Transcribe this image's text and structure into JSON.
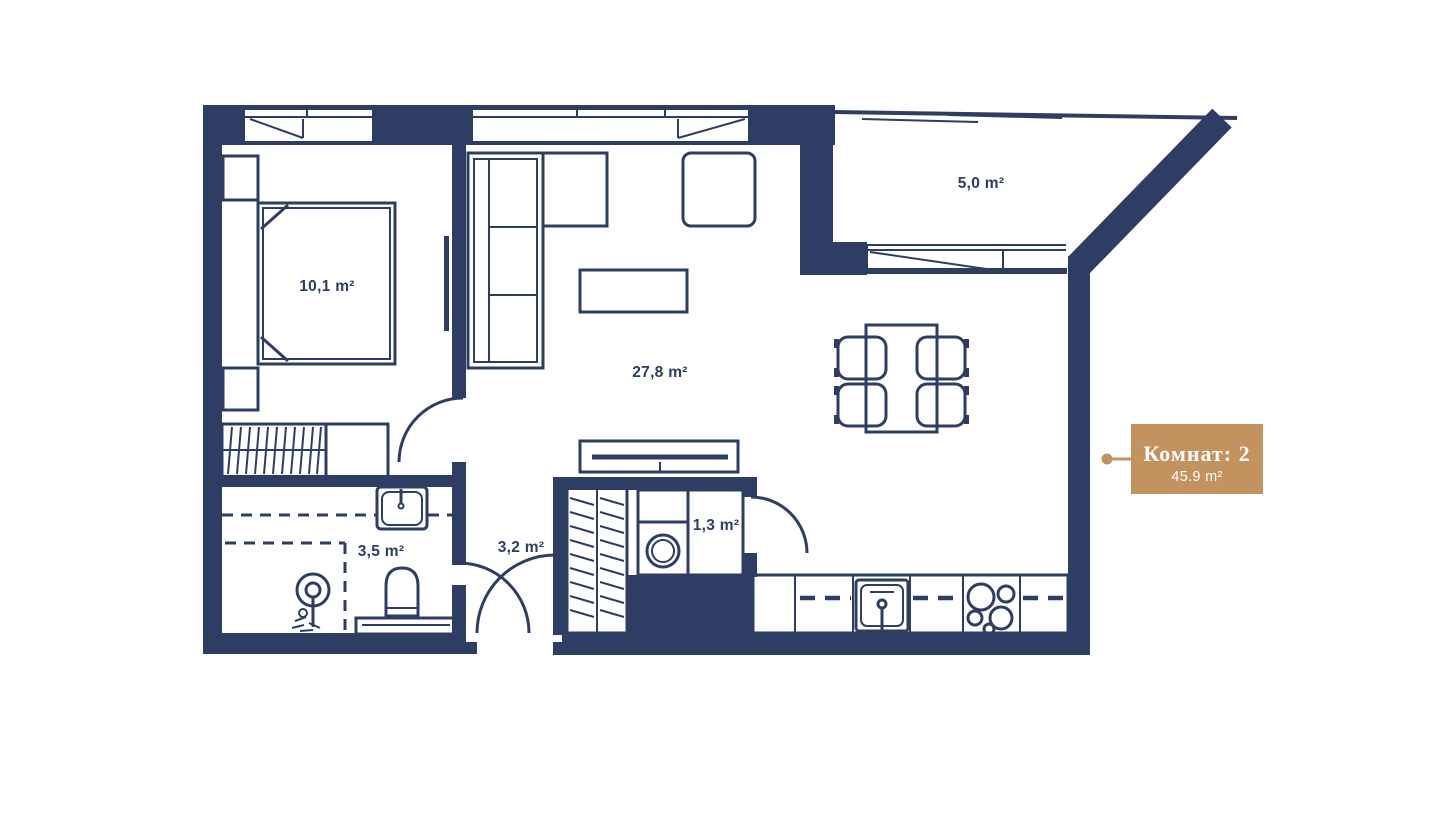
{
  "plan": {
    "badge": {
      "title": "Комнат: 2",
      "area": "45.9 m²"
    },
    "rooms": {
      "bedroom": {
        "name": "bedroom",
        "area": "10,1 m²"
      },
      "living": {
        "name": "living-room",
        "area": "27,8 m²"
      },
      "balcony": {
        "name": "balcony",
        "area": "5,0 m²"
      },
      "bathroom": {
        "name": "bathroom",
        "area": "3,5 m²"
      },
      "hallway": {
        "name": "hallway",
        "area": "3,2 m²"
      },
      "utility": {
        "name": "utility-closet",
        "area": "1,3 m²"
      }
    },
    "colors": {
      "wall": "#2d3d63",
      "accent": "#c2935e",
      "background": "#ffffff"
    }
  }
}
